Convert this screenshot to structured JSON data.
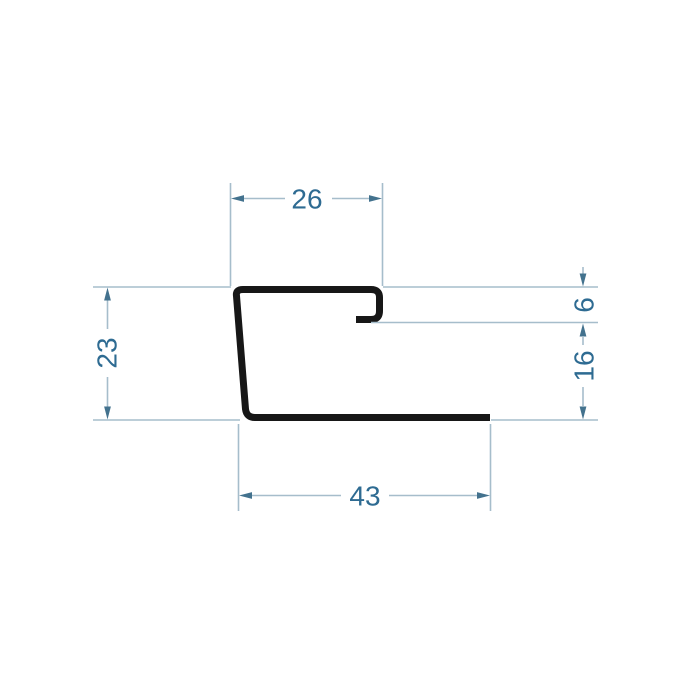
{
  "drawing": {
    "kind": "profile-cross-section-technical-drawing",
    "dimensions": {
      "top_width": {
        "label": "26",
        "orientation": "horizontal",
        "position": "top"
      },
      "left_height": {
        "label": "23",
        "orientation": "vertical",
        "position": "left"
      },
      "lip_depth": {
        "label": "6",
        "orientation": "vertical",
        "position": "right-upper"
      },
      "right_height": {
        "label": "16",
        "orientation": "vertical",
        "position": "right-lower"
      },
      "bottom_width": {
        "label": "43",
        "orientation": "horizontal",
        "position": "bottom"
      }
    },
    "colors": {
      "profile": "#171717",
      "thin_line": "#a6bdcb",
      "arrow": "#43728e",
      "label": "#2e6b92",
      "background": "#ffffff"
    }
  }
}
